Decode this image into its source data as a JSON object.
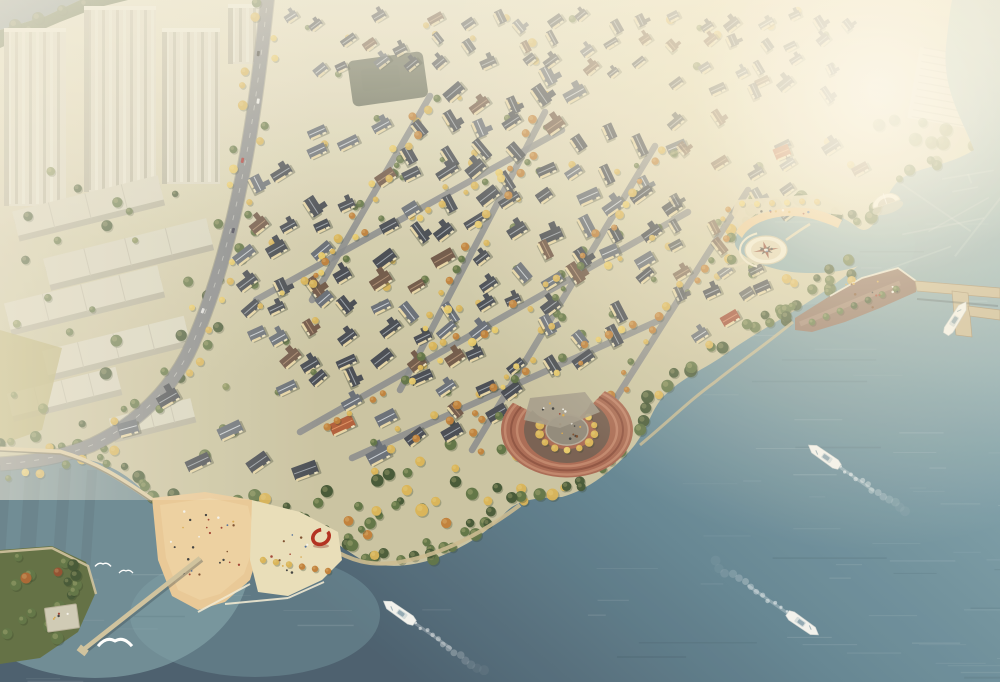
{
  "meta": {
    "description": "Hazy golden-hour aerial rendering of a waterfront villa community: dense gabled villas with autumn street trees, high-rise apartment slabs upper left, a wide teal river with speedboats and white wakes, a circular compass plaza in a cove, a timber waterfront deck with an L-shaped pier and moored boat, a terraced semicircular amphitheater, and a sandy beach plaza with a red ring sculpture and stone jetty"
  },
  "palette": {
    "land": "#c9c2a0",
    "land_light": "#e6e0c6",
    "water_haze": "#aec6c9",
    "water_light": "#7b9da8",
    "water_mid": "#5f8190",
    "water_deep": "#44596a",
    "bay": "#8fb5ba",
    "shallow": "#7fa3ab",
    "haze": "#f6efdd",
    "sun": "#fff3d6",
    "tree_dark": "#3f5230",
    "tree_green": "#5c7040",
    "tree_olive": "#7d8a52",
    "autumn": "#d9b253",
    "autumn_bright": "#e8c865",
    "autumn_orange": "#c07c35",
    "roof_dark": "#43474f",
    "roof_mid": "#656b74",
    "roof_brown": "#6e5546",
    "roof_orange": "#b05a36",
    "roof_red": "#9e4632",
    "wall": "#ecd9a8",
    "road": "#85878a",
    "road_line": "#d9d9d4",
    "sand": "#e9c794",
    "plaza": "#e9ddb8",
    "pavement": "#d9cfae",
    "terrace": "#a86750",
    "terrace_light": "#c08268",
    "terrace_dark": "#8d4f3d",
    "deck": "#8d6e60",
    "pier": "#c9b894",
    "stone": "#6e6a58",
    "tower": "#dcd8c6",
    "tower_shade": "#b5b19e",
    "tower_stripe": "#e9e6d6",
    "white": "#f7f5ee",
    "ring_red": "#b02818"
  },
  "scene": {
    "boats": [
      {
        "name": "speedboat-southwest",
        "x": 399,
        "y": 612,
        "heading": 215,
        "wake_length": 90
      },
      {
        "name": "speedboat-midriver",
        "x": 824,
        "y": 456,
        "heading": 215,
        "wake_length": 85
      },
      {
        "name": "speedboat-northeast",
        "x": 803,
        "y": 624,
        "heading": 35,
        "wake_length": 95
      },
      {
        "name": "moored-boat",
        "x": 956,
        "y": 318,
        "heading": -58,
        "wake_length": 0
      }
    ],
    "gulls": [
      {
        "x": 115,
        "y": 641,
        "s": 1.7
      },
      {
        "x": 103,
        "y": 564,
        "s": 0.8
      },
      {
        "x": 126,
        "y": 571,
        "s": 0.7
      }
    ],
    "landmarks": {
      "compass_plaza": {
        "x": 766,
        "y": 250,
        "label": "circular compass plaza in cove"
      },
      "cove_beach": {
        "x": 780,
        "y": 218,
        "label": "crescent beach"
      },
      "shell_pavilion": {
        "x": 886,
        "y": 202,
        "label": "white shell canopy"
      },
      "boardwalk": {
        "x": 865,
        "y": 298,
        "label": "waterfront deck"
      },
      "marina_pier": {
        "x": 960,
        "y": 300,
        "label": "L-shaped pier"
      },
      "amphitheater": {
        "x": 567,
        "y": 430,
        "label": "terraced waterfront amphitheater"
      },
      "beach_plaza": {
        "x": 248,
        "y": 552,
        "label": "sandy event plaza"
      },
      "ring_sculpture": {
        "x": 321,
        "y": 537,
        "label": "red ring sculpture"
      },
      "jetty": {
        "x1": 200,
        "y1": 558,
        "x2": 83,
        "y2": 650,
        "label": "stone jetty"
      },
      "park_point": {
        "x": 48,
        "y": 600,
        "label": "green headland park"
      },
      "parking_lot": {
        "x": 957,
        "y": 90,
        "label": "hazy parking area"
      },
      "hilltop_court": {
        "x": 388,
        "y": 80,
        "label": "dark paved court"
      }
    },
    "districts": [
      {
        "name": "central-villas",
        "houses": 110
      },
      {
        "name": "north-villas",
        "houses": 38
      },
      {
        "name": "east-villas",
        "houses": 32
      },
      {
        "name": "shore-villas",
        "houses": 10
      },
      {
        "name": "cove-villas",
        "houses": 5
      }
    ],
    "city": {
      "towers": 3,
      "slabs": 6
    }
  }
}
